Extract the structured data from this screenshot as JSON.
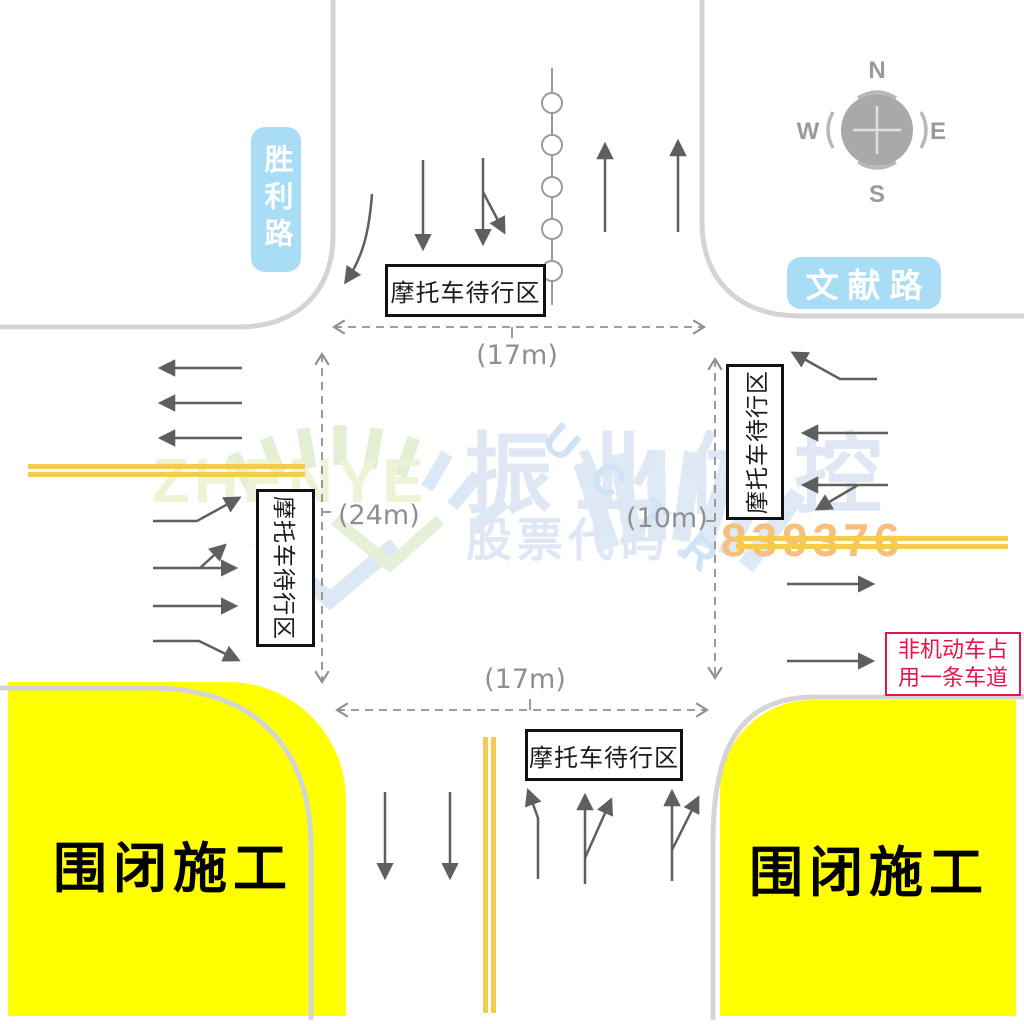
{
  "roads": {
    "west_label": "胜利路",
    "east_label": "文献路"
  },
  "compass": {
    "n": "N",
    "e": "E",
    "s": "S",
    "w": "W"
  },
  "boxes": {
    "moto_wait": "摩托车待行区"
  },
  "dimensions": {
    "top": "(17m)",
    "bottom": "(17m)",
    "west": "(24m)",
    "east": "(10m)"
  },
  "construction": {
    "label": "围闭施工"
  },
  "note": {
    "line1": "非机动车占",
    "line2": "用一条车道"
  },
  "watermark": {
    "brand": "振业优控",
    "stock_label": "股票代码：",
    "stock_code": "839376",
    "logo": "ZHENYE",
    "logo_letters": [
      "U",
      "C",
      "T",
      "R"
    ]
  },
  "colors": {
    "construction_yellow": "#ffff00",
    "lane_line_yellow": "#f6c94f",
    "road_label_blue": "#a9dcf5",
    "note_red": "#e8134b",
    "arrow_gray": "#5f5f5f",
    "curb_gray": "#d4d4d4",
    "dash_gray": "#909090",
    "watermark_blue": "#dee7f3",
    "watermark_orange": "#f6bf7e"
  }
}
